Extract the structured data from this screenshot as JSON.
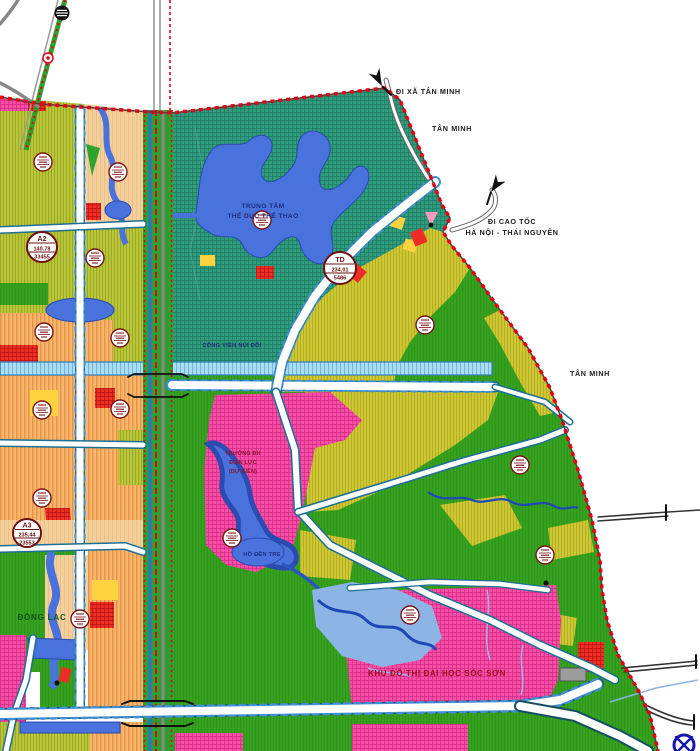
{
  "map": {
    "type": "urban-planning-zoning-map",
    "labels": {
      "di_xa_tan_minh": "ĐI XÃ TÂN MINH",
      "tan_minh_north": "TÂN MINH",
      "di_cao_toc_line1": "ĐI CAO TỐC",
      "di_cao_toc_line2": "HÀ NỘI - THÁI NGUYÊN",
      "tan_minh_east": "TÂN MINH",
      "sports_center_line1": "TRUNG TÂM",
      "sports_center_line2": "THỂ DỤC THỂ THAO",
      "park": "CÔNG VIÊN NÚI ĐÔI",
      "university_line1": "TRƯỜNG ĐH",
      "university_line2": "ĐIỆN LỰC",
      "university_line3": "(DỰ KIẾN)",
      "lake": "HỒ ĐỀN TRE",
      "uni_urban_area": "KHU ĐÔ THỊ ĐẠI HỌC SÓC SƠN",
      "dong_lac": "ĐỒNG LẠC"
    },
    "zone_badges": {
      "a2": {
        "code": "A2",
        "area": "140.78",
        "pop": "33455"
      },
      "a3": {
        "code": "A3",
        "area": "235.44",
        "pop": "23553"
      },
      "td": {
        "code": "TD",
        "area": "234.01",
        "pop": "5486"
      }
    },
    "colors": {
      "boundary_red": "#e60012",
      "park_teal": "#2f9c7d",
      "green_land": "#35a11f",
      "residential_orange": "#f6b66f",
      "mixed_olive": "#b9c437",
      "mustard": "#cdc733",
      "urban_pink": "#f84fa6",
      "red_block": "#ee2e24",
      "water_blue": "#4a72dd",
      "canal_blue": "#aadcf2",
      "yellow_block": "#ffd23f",
      "road_casing": "#1d6f96"
    }
  }
}
